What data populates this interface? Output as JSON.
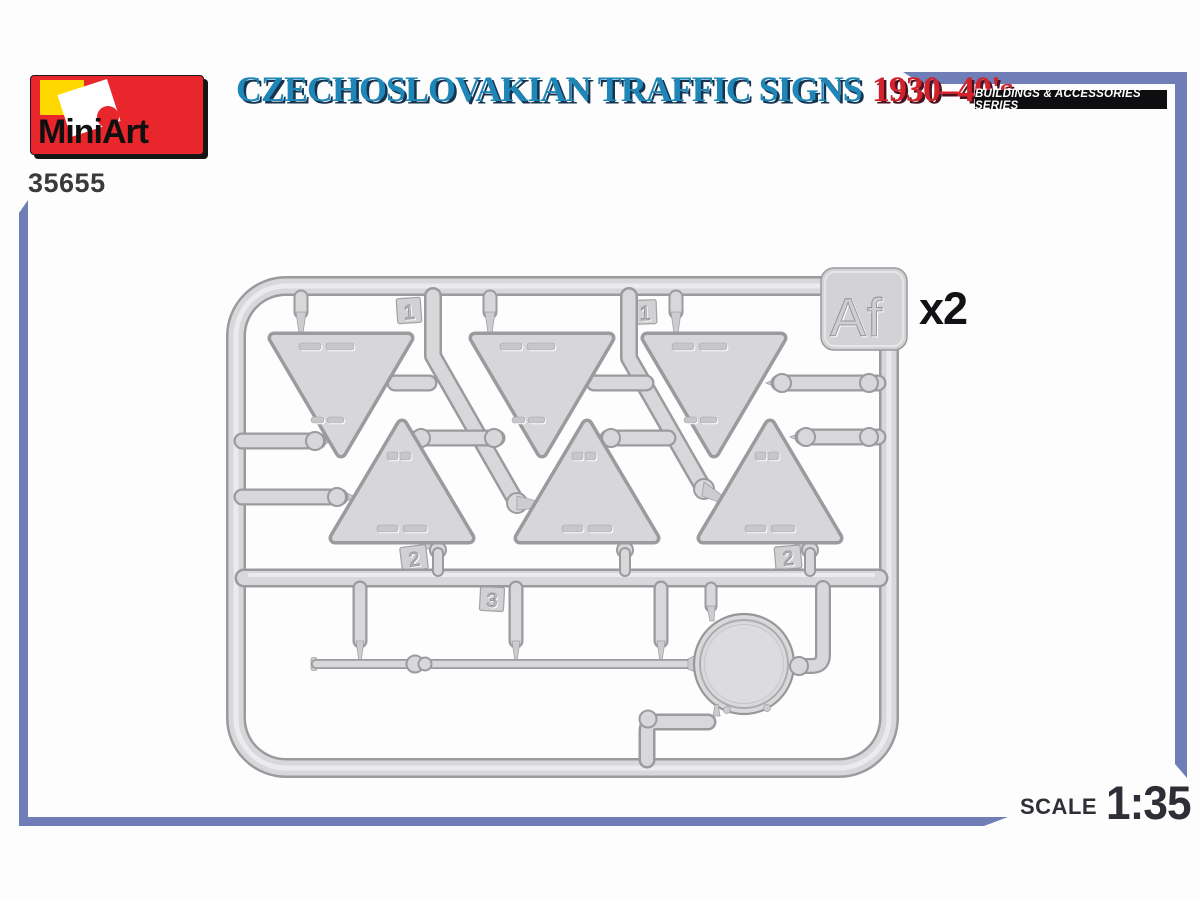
{
  "header": {
    "brand": "MiniArt",
    "product_code": "35655",
    "title_main": "CZECHOSLOVAKIAN TRAFFIC SIGNS",
    "title_years": "1930–40's",
    "series_badge": "BUILDINGS & ACCESSORIES SERIES"
  },
  "sprue": {
    "letter": "Af",
    "quantity": "x2",
    "part_tags": [
      "1",
      "1",
      "2",
      "2",
      "3"
    ]
  },
  "footer": {
    "scale_label": "SCALE",
    "scale_value": "1:35"
  },
  "colors": {
    "accent_blue": "#1f86b8",
    "accent_red": "#d2232c",
    "rule_periwinkle": "#6f7eb6",
    "logo_red": "#e8262c",
    "logo_yellow": "#ffd800",
    "badge_black": "#0e0e10",
    "plastic_face": "#d7d7da",
    "plastic_edge": "#9b9b9f",
    "text_dark": "#2e2f36"
  }
}
